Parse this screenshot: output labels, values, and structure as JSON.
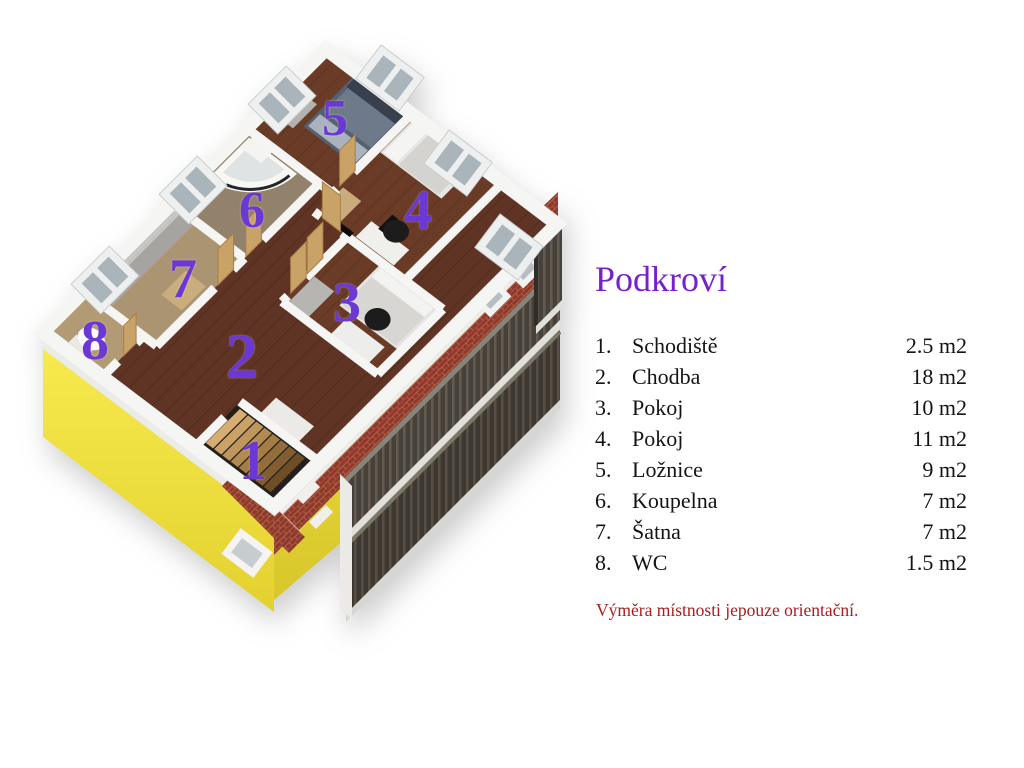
{
  "legend": {
    "title": "Podkroví",
    "rooms": [
      {
        "num": "1.",
        "name": "Schodiště",
        "area": "2.5 m2"
      },
      {
        "num": "2.",
        "name": "Chodba",
        "area": "18 m2"
      },
      {
        "num": "3.",
        "name": "Pokoj",
        "area": "10 m2"
      },
      {
        "num": "4.",
        "name": "Pokoj",
        "area": "11 m2"
      },
      {
        "num": "5.",
        "name": "Ložnice",
        "area": "9 m2"
      },
      {
        "num": "6.",
        "name": "Koupelna",
        "area": "7 m2"
      },
      {
        "num": "7.",
        "name": "Šatna",
        "area": "7 m2"
      },
      {
        "num": "8.",
        "name": "WC",
        "area": "1.5 m2"
      }
    ],
    "note": "Výměra místnosti jepouze orientační."
  },
  "floorplan": {
    "labels": [
      {
        "n": "1",
        "x": 253,
        "y": 462,
        "s": 56
      },
      {
        "n": "2",
        "x": 242,
        "y": 358,
        "s": 64
      },
      {
        "n": "3",
        "x": 347,
        "y": 304,
        "s": 56
      },
      {
        "n": "4",
        "x": 418,
        "y": 212,
        "s": 56
      },
      {
        "n": "5",
        "x": 335,
        "y": 120,
        "s": 52
      },
      {
        "n": "6",
        "x": 252,
        "y": 212,
        "s": 52
      },
      {
        "n": "7",
        "x": 183,
        "y": 280,
        "s": 56
      },
      {
        "n": "8",
        "x": 95,
        "y": 342,
        "s": 56
      }
    ]
  },
  "colors": {
    "purple_title": "#7721cc",
    "purple_number": "#6b38d4",
    "text": "#141414",
    "note_red": "#aa1d1d",
    "facade_yellow": "#f1e23b",
    "brick_red": "#8e3a2b",
    "wood_floor": "#5f3424",
    "wall_white": "#f5f5f3"
  }
}
